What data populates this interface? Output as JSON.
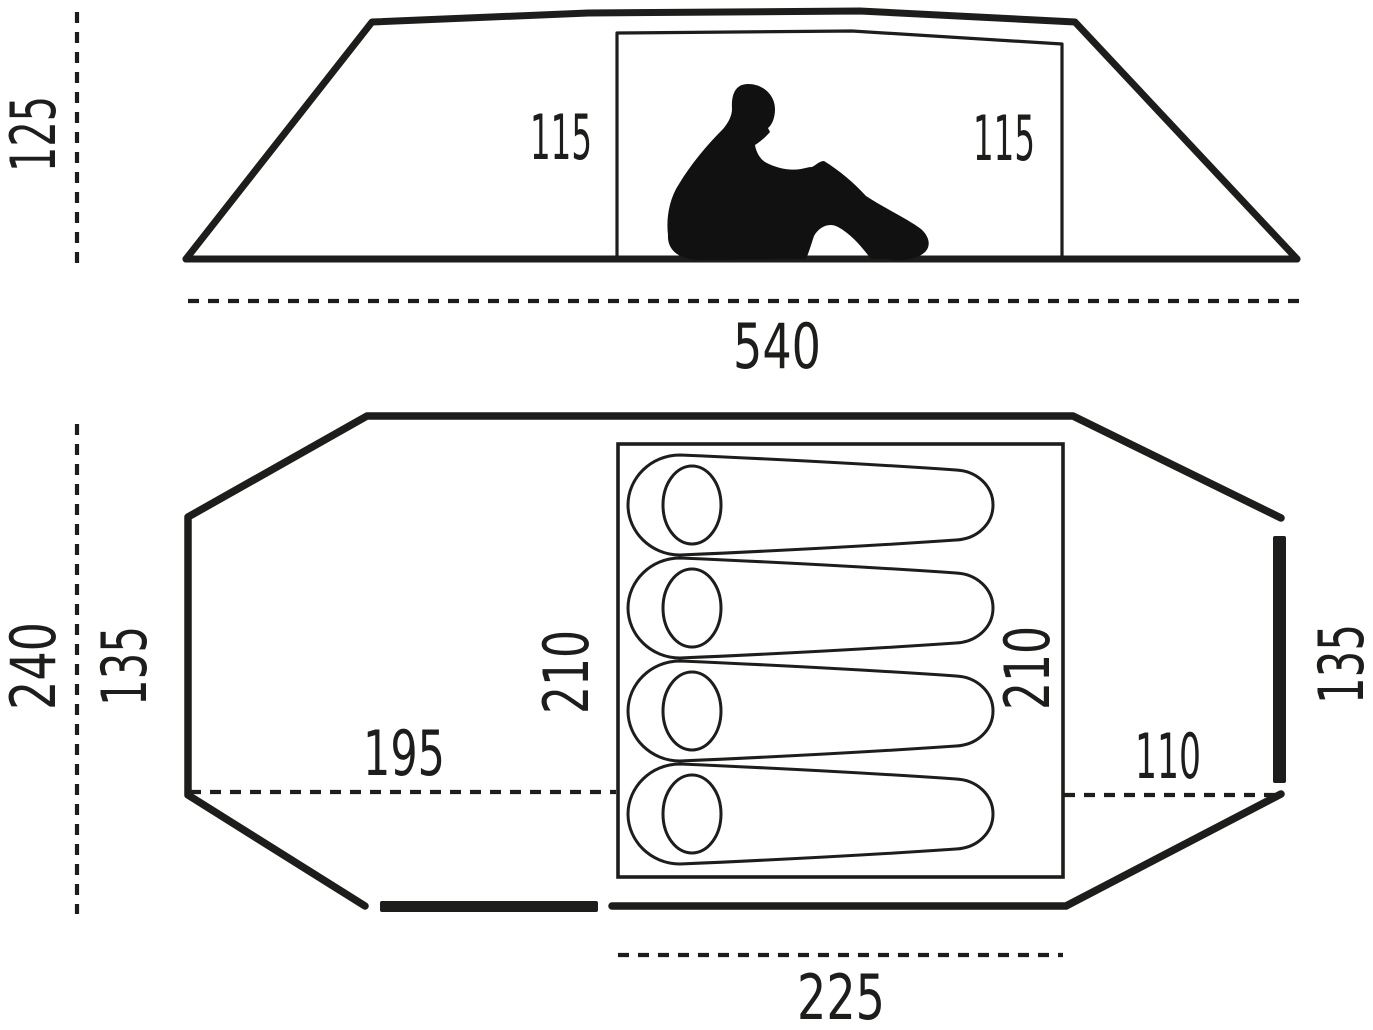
{
  "title": "Tent dimensions diagram",
  "colors": {
    "line": "#1d1d1b",
    "background": "#ffffff"
  },
  "side_view": {
    "height": "125",
    "inner_height_left": "115",
    "inner_height_right": "115",
    "length": "540"
  },
  "floor_plan": {
    "width": "240",
    "inner_width_left": "135",
    "inner_width_right": "135",
    "inner_length_left": "210",
    "inner_length_right": "210",
    "front_vestibule_depth": "195",
    "rear_vestibule_depth": "110",
    "inner_bottom_width": "225",
    "sleeping_bag_count": 4
  }
}
